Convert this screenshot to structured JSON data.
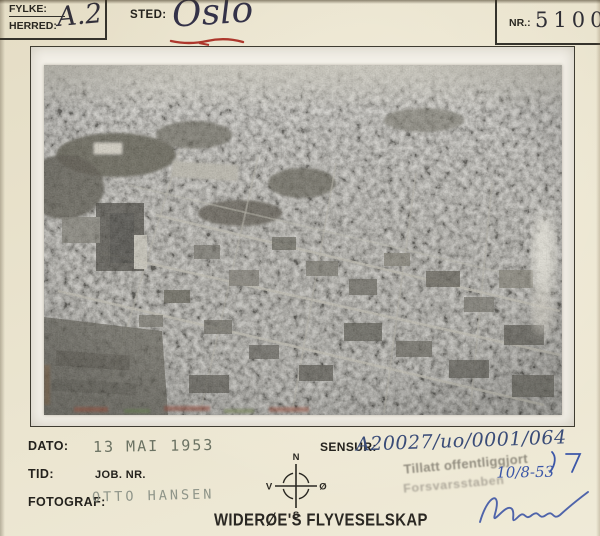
{
  "colors": {
    "card_background": "#ece6d1",
    "frame_line": "#3f3c31",
    "photo_paper": "#f3f0e8",
    "print_ink": "#24221d",
    "handwriting_ink": "#32303a",
    "blue_ink": "#3c57a8",
    "red_underline": "#ad372c",
    "stamp_gray": "#8e897c",
    "date_stamp_green": "#5e6657"
  },
  "header": {
    "fylke_label": "FYLKE:",
    "herred_label": "HERRED:",
    "fylke_herred_value": "A.2",
    "sted_label": "STED:",
    "sted_value": "Oslo",
    "nr_label": "NR.:",
    "nr_value": "51000"
  },
  "footer": {
    "dato_label": "DATO:",
    "dato_value": "13 MAI 1953",
    "tid_label": "TID:",
    "job_nr_label": "JOB. NR.",
    "fotograf_label": "FOTOGRAF:",
    "fotograf_value": "OTTO HANSEN",
    "sensur_label": "SENSUR:",
    "sensur_value": "A20027/uo/0001/064",
    "company_name": "WIDERØE'S FLYVESELSKAP"
  },
  "approval_stamp": {
    "line1": "Tillatt offentliggjort",
    "line2": "Forsvarsstaben",
    "handwritten_date": "10/8-53"
  },
  "compass": {
    "north": "N",
    "south": "S",
    "west": "V",
    "east": "Ø"
  }
}
